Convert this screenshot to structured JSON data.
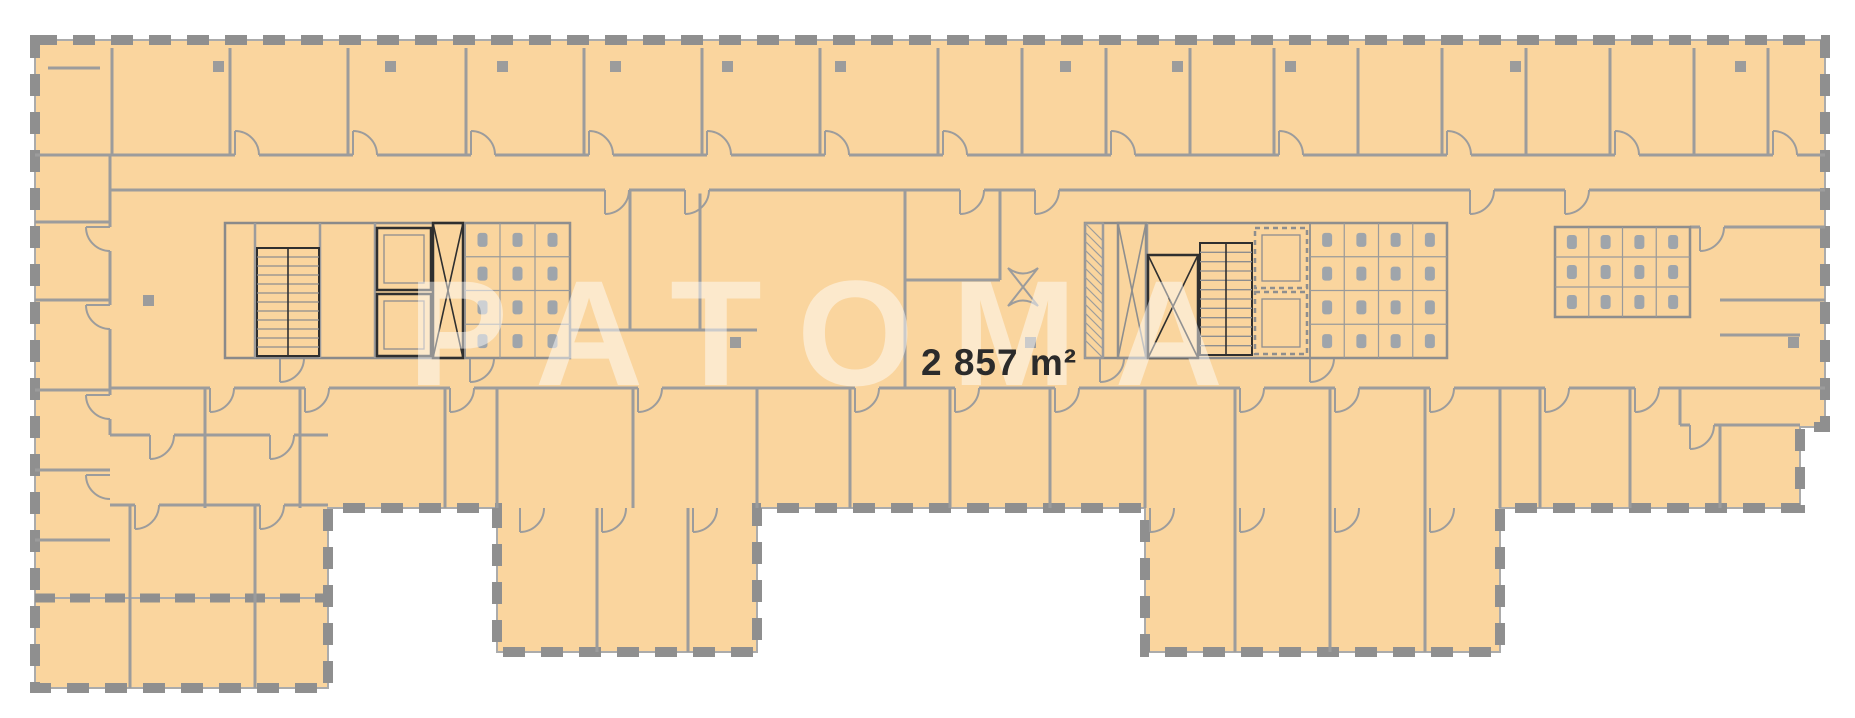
{
  "floorplan": {
    "area_label": "2 857 m²",
    "watermark": "PATOMA",
    "colors": {
      "floor": "#FAD59E",
      "outside": "#FFFFFF",
      "wall": "#9C9C9C",
      "window_dash": "#8F8F8F",
      "outline_line": "#ABABAB",
      "core": "#2F2F2F",
      "fixture": "#9FA5AB",
      "label": "#2B2B2B",
      "watermark_color": "#FFFFFF"
    },
    "outline": [
      [
        35,
        40
      ],
      [
        1825,
        40
      ],
      [
        1825,
        427
      ],
      [
        1800,
        427
      ],
      [
        1800,
        508
      ],
      [
        1500,
        508
      ],
      [
        1500,
        652
      ],
      [
        1145,
        652
      ],
      [
        1145,
        508
      ],
      [
        757,
        508
      ],
      [
        757,
        652
      ],
      [
        497,
        652
      ],
      [
        497,
        508
      ],
      [
        328,
        508
      ],
      [
        328,
        688
      ],
      [
        35,
        688
      ]
    ],
    "dash_walls": [
      [
        35,
        598,
        328,
        598
      ]
    ],
    "walls": [
      [
        35,
        155,
        1825,
        155
      ],
      [
        110,
        190,
        1825,
        190
      ],
      [
        112,
        48,
        112,
        155
      ],
      [
        230,
        48,
        230,
        155
      ],
      [
        348,
        48,
        348,
        155
      ],
      [
        466,
        48,
        466,
        155
      ],
      [
        584,
        48,
        584,
        155
      ],
      [
        702,
        48,
        702,
        155
      ],
      [
        820,
        48,
        820,
        155
      ],
      [
        938,
        48,
        938,
        155
      ],
      [
        1022,
        48,
        1022,
        155
      ],
      [
        1106,
        48,
        1106,
        155
      ],
      [
        1190,
        48,
        1190,
        155
      ],
      [
        1274,
        48,
        1274,
        155
      ],
      [
        1358,
        48,
        1358,
        155
      ],
      [
        1442,
        48,
        1442,
        155
      ],
      [
        1526,
        48,
        1526,
        155
      ],
      [
        1610,
        48,
        1610,
        155
      ],
      [
        1694,
        48,
        1694,
        155
      ],
      [
        1768,
        48,
        1768,
        155
      ],
      [
        48,
        68,
        100,
        68
      ],
      [
        110,
        155,
        110,
        435
      ],
      [
        35,
        222,
        110,
        222
      ],
      [
        35,
        300,
        110,
        300
      ],
      [
        35,
        390,
        110,
        390
      ],
      [
        35,
        470,
        110,
        470
      ],
      [
        35,
        540,
        110,
        540
      ],
      [
        110,
        435,
        328,
        435
      ],
      [
        110,
        505,
        328,
        505
      ],
      [
        130,
        505,
        130,
        688
      ],
      [
        255,
        505,
        255,
        688
      ],
      [
        110,
        388,
        1825,
        388
      ],
      [
        205,
        388,
        205,
        508
      ],
      [
        300,
        388,
        300,
        508
      ],
      [
        445,
        388,
        445,
        508
      ],
      [
        633,
        388,
        633,
        508
      ],
      [
        850,
        388,
        850,
        508
      ],
      [
        950,
        388,
        950,
        508
      ],
      [
        1050,
        388,
        1050,
        508
      ],
      [
        1540,
        388,
        1540,
        508
      ],
      [
        1630,
        388,
        1630,
        508
      ],
      [
        1680,
        388,
        1680,
        425
      ],
      [
        1720,
        425,
        1720,
        508
      ],
      [
        497,
        388,
        497,
        508
      ],
      [
        757,
        388,
        757,
        508
      ],
      [
        1145,
        388,
        1145,
        508
      ],
      [
        1500,
        388,
        1500,
        508
      ],
      [
        597,
        508,
        597,
        652
      ],
      [
        688,
        508,
        688,
        652
      ],
      [
        1235,
        388,
        1235,
        652
      ],
      [
        1330,
        388,
        1330,
        652
      ],
      [
        1425,
        388,
        1425,
        652
      ],
      [
        1690,
        227,
        1825,
        227
      ],
      [
        1720,
        300,
        1825,
        300
      ],
      [
        1720,
        335,
        1800,
        335
      ],
      [
        1680,
        425,
        1800,
        425
      ],
      [
        570,
        330,
        757,
        330
      ],
      [
        630,
        190,
        630,
        330
      ],
      [
        700,
        190,
        700,
        330
      ],
      [
        905,
        190,
        905,
        388
      ],
      [
        905,
        280,
        1000,
        280
      ],
      [
        1000,
        190,
        1000,
        280
      ]
    ],
    "doors": [
      [
        235,
        155,
        "ur"
      ],
      [
        353,
        155,
        "ur"
      ],
      [
        471,
        155,
        "ur"
      ],
      [
        589,
        155,
        "ur"
      ],
      [
        707,
        155,
        "ur"
      ],
      [
        825,
        155,
        "ur"
      ],
      [
        943,
        155,
        "ur"
      ],
      [
        1111,
        155,
        "ur"
      ],
      [
        1279,
        155,
        "ur"
      ],
      [
        1447,
        155,
        "ur"
      ],
      [
        1615,
        155,
        "ur"
      ],
      [
        1773,
        155,
        "ur"
      ],
      [
        605,
        190,
        "dr"
      ],
      [
        685,
        190,
        "dr"
      ],
      [
        960,
        190,
        "dr"
      ],
      [
        1035,
        190,
        "dr"
      ],
      [
        1470,
        190,
        "dr"
      ],
      [
        1565,
        190,
        "dr"
      ],
      [
        210,
        388,
        "dr"
      ],
      [
        305,
        388,
        "dr"
      ],
      [
        450,
        388,
        "dr"
      ],
      [
        638,
        388,
        "dr"
      ],
      [
        855,
        388,
        "dr"
      ],
      [
        955,
        388,
        "dr"
      ],
      [
        1055,
        388,
        "dr"
      ],
      [
        1240,
        388,
        "dr"
      ],
      [
        1335,
        388,
        "dr"
      ],
      [
        1430,
        388,
        "dr"
      ],
      [
        1545,
        388,
        "dr"
      ],
      [
        1635,
        388,
        "dr"
      ],
      [
        110,
        227,
        "ld"
      ],
      [
        110,
        305,
        "ld"
      ],
      [
        110,
        395,
        "ld"
      ],
      [
        110,
        475,
        "ld"
      ],
      [
        520,
        508,
        "dr"
      ],
      [
        602,
        508,
        "dr"
      ],
      [
        693,
        508,
        "dr"
      ],
      [
        1150,
        508,
        "dr"
      ],
      [
        1240,
        508,
        "dr"
      ],
      [
        1335,
        508,
        "dr"
      ],
      [
        1430,
        508,
        "dr"
      ],
      [
        150,
        435,
        "dr"
      ],
      [
        270,
        435,
        "dr"
      ],
      [
        135,
        505,
        "dr"
      ],
      [
        260,
        505,
        "dr"
      ],
      [
        280,
        358,
        "dr"
      ],
      [
        470,
        358,
        "dr"
      ],
      [
        1100,
        358,
        "dr"
      ],
      [
        1310,
        358,
        "dr"
      ],
      [
        1690,
        425,
        "dr"
      ],
      [
        1700,
        227,
        "dr"
      ]
    ],
    "columns": [
      [
        218,
        66
      ],
      [
        390,
        66
      ],
      [
        502,
        66
      ],
      [
        615,
        66
      ],
      [
        727,
        66
      ],
      [
        840,
        66
      ],
      [
        1065,
        66
      ],
      [
        1177,
        66
      ],
      [
        1290,
        66
      ],
      [
        1515,
        66
      ],
      [
        1740,
        66
      ],
      [
        148,
        300
      ],
      [
        735,
        342
      ],
      [
        1030,
        342
      ],
      [
        1793,
        342
      ]
    ],
    "bowtie": {
      "x": 1023,
      "y": 287
    },
    "cores": [
      {
        "x": 225,
        "y": 223,
        "w": 345,
        "h": 135,
        "lines": [
          [
            255,
            223,
            255,
            358
          ],
          [
            320,
            223,
            320,
            358
          ],
          [
            375,
            223,
            375,
            358
          ]
        ],
        "stairs": [
          {
            "x": 257,
            "y": 248,
            "w": 62,
            "h": 108
          }
        ],
        "elevators": [
          {
            "x": 377,
            "y": 228,
            "w": 54,
            "h": 62
          },
          {
            "x": 377,
            "y": 294,
            "w": 54,
            "h": 62
          }
        ],
        "xshafts": [
          {
            "x": 433,
            "y": 223,
            "w": 30,
            "h": 135,
            "b": 1
          }
        ],
        "wc": [
          {
            "x": 465,
            "y": 223,
            "w": 105,
            "h": 135,
            "cols": 3,
            "rows": 4
          }
        ],
        "hatch": []
      },
      {
        "x": 1085,
        "y": 223,
        "w": 362,
        "h": 135,
        "lines": [
          [
            1103,
            223,
            1103,
            358
          ],
          [
            1147,
            223,
            1147,
            358
          ]
        ],
        "stairs": [
          {
            "x": 1200,
            "y": 243,
            "w": 52,
            "h": 112
          }
        ],
        "elevators": [
          {
            "x": 1255,
            "y": 228,
            "w": 52,
            "h": 60,
            "d": 1
          },
          {
            "x": 1255,
            "y": 292,
            "w": 52,
            "h": 62,
            "d": 1
          }
        ],
        "xshafts": [
          {
            "x": 1118,
            "y": 223,
            "w": 28,
            "h": 135
          },
          {
            "x": 1148,
            "y": 255,
            "w": 50,
            "h": 103,
            "b": 1
          }
        ],
        "wc": [
          {
            "x": 1310,
            "y": 223,
            "w": 137,
            "h": 135,
            "cols": 4,
            "rows": 4
          }
        ],
        "hatch": [
          {
            "x": 1085,
            "y": 223,
            "w": 18,
            "h": 135
          }
        ]
      },
      {
        "x": 1555,
        "y": 227,
        "w": 135,
        "h": 90,
        "lines": [],
        "stairs": [],
        "elevators": [],
        "xshafts": [],
        "wc": [
          {
            "x": 1555,
            "y": 227,
            "w": 135,
            "h": 90,
            "cols": 4,
            "rows": 3
          }
        ],
        "hatch": []
      }
    ]
  }
}
